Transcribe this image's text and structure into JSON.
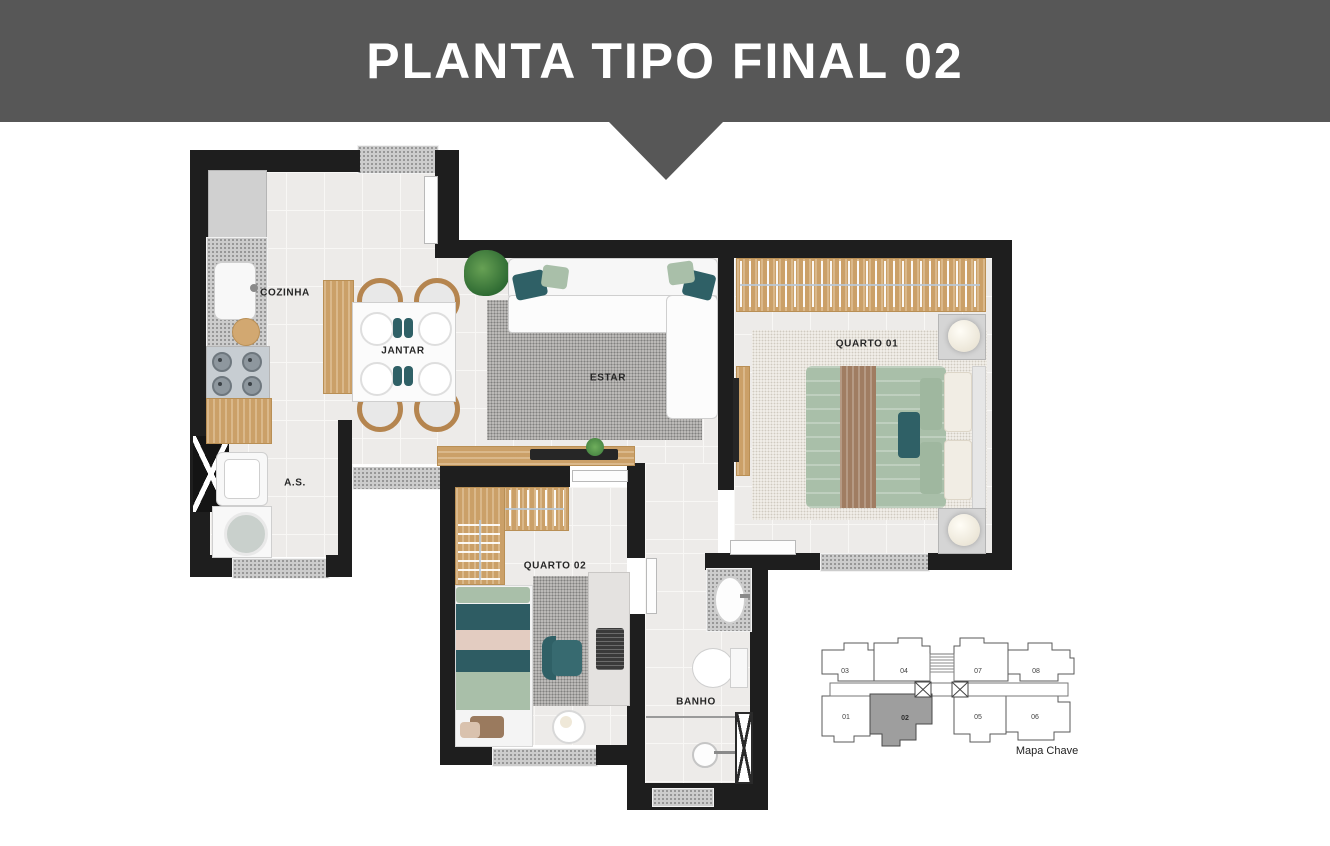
{
  "header": {
    "title": "PLANTA TIPO FINAL 02"
  },
  "rooms": {
    "cozinha": "COZINHA",
    "jantar": "JANTAR",
    "estar": "ESTAR",
    "quarto1": "QUARTO 01",
    "as": "A.S.",
    "quarto2": "QUARTO 02",
    "banho": "BANHO"
  },
  "key_map": {
    "caption": "Mapa Chave",
    "highlighted_unit": "02",
    "units_top": [
      {
        "label": "03"
      },
      {
        "label": "04"
      },
      {
        "label": "07"
      },
      {
        "label": "08"
      }
    ],
    "units_bottom": [
      {
        "label": "01"
      },
      {
        "label": "02"
      },
      {
        "label": "05"
      },
      {
        "label": "06"
      }
    ]
  },
  "colors": {
    "banner": "#575757",
    "wall": "#1e1e1e",
    "floor": "#edebe9",
    "accent_teal": "#2f6066",
    "accent_sage": "#a9bfa9",
    "wood": "#d2a871",
    "highlighted_unit_fill": "#9e9e9e"
  }
}
